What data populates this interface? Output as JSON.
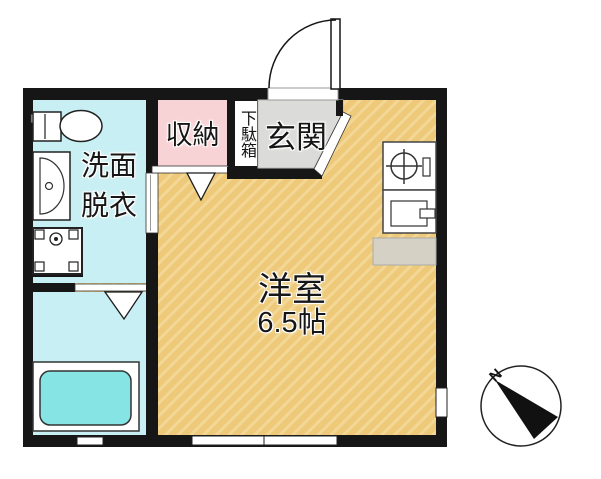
{
  "title": "apartment-floor-plan",
  "labels": {
    "washroom": "洗面\n脱衣",
    "closet": "収納",
    "shoe_cabinet": "下駄箱",
    "entrance": "玄関",
    "main_room_name": "洋室",
    "main_room_size": "6.5帖",
    "compass_north": "N"
  },
  "fixtures": [
    "toilet",
    "vanity-sink",
    "washing-machine",
    "bathtub",
    "gas-stove",
    "kitchen-sink",
    "kitchen-counter",
    "entrance-door-swing",
    "closet-door-arrow",
    "bathroom-door-arrow",
    "window-right-wall",
    "window-bottom-main",
    "window-bottom-bathroom",
    "compass-north-needle"
  ],
  "colors": {
    "wall": "#161616",
    "main_room_floor": "#edc979",
    "main_room_hatch": "#f5dc9e",
    "wet_area_floor": "#c8eff3",
    "bathtub": "#86e4e4",
    "closet": "#f8d3d6",
    "entrance_floor": "#dbdbd9",
    "counter": "#d6d1c5",
    "background": "#ffffff"
  }
}
